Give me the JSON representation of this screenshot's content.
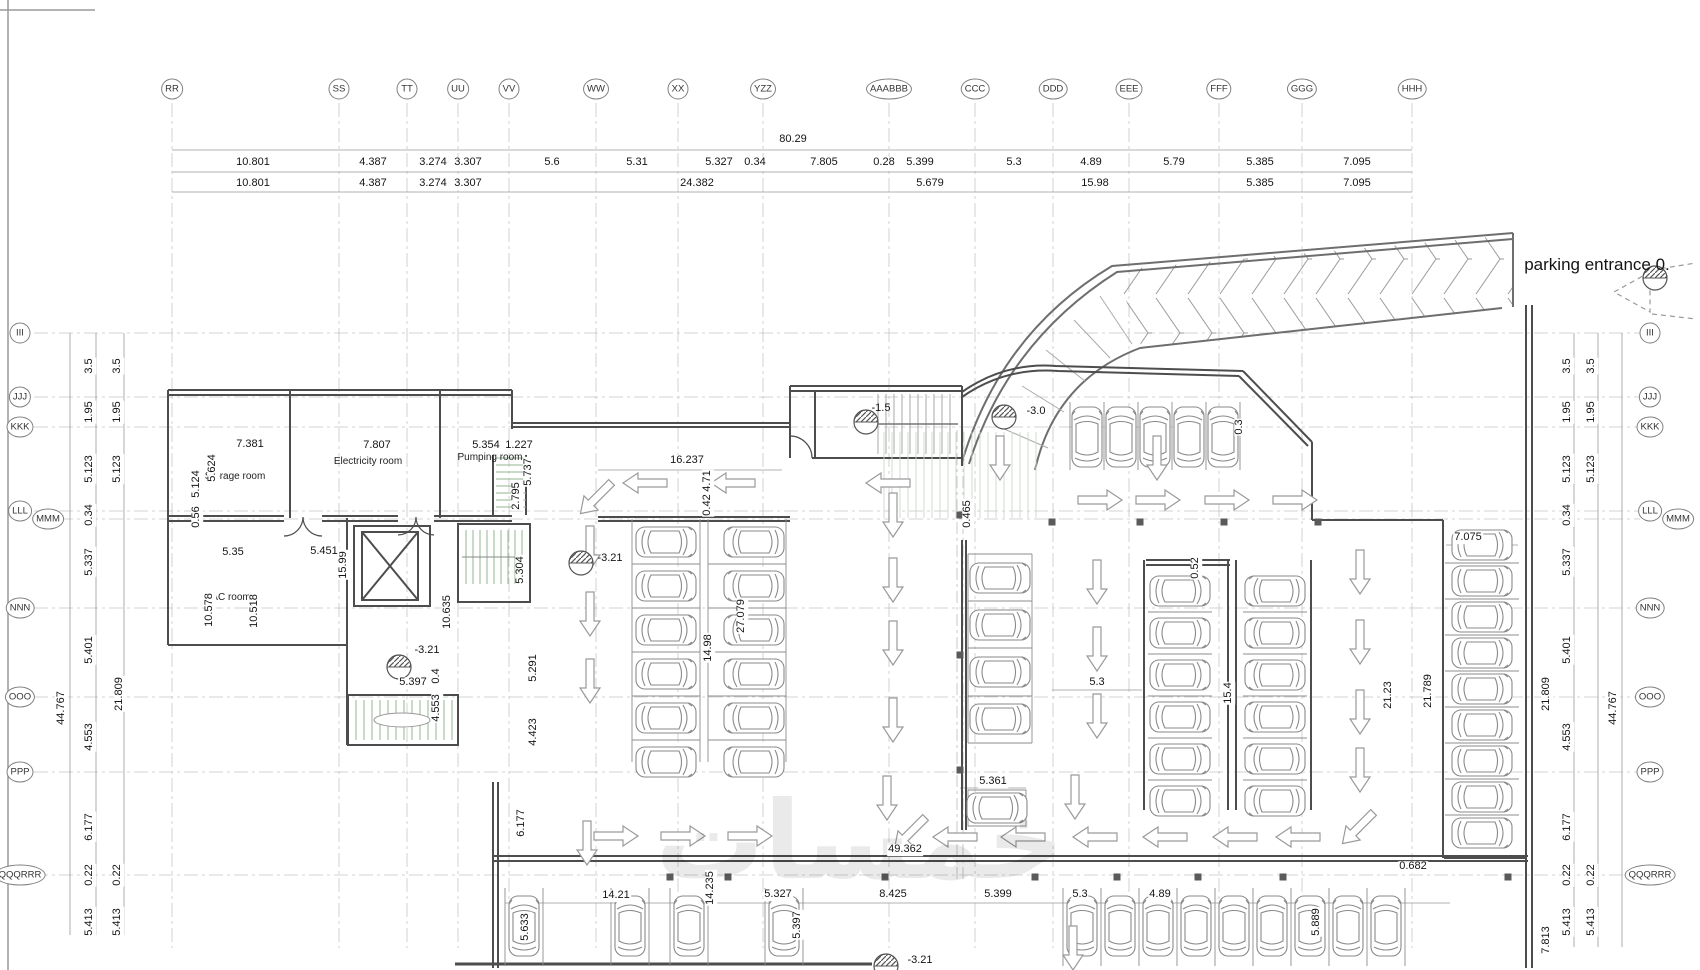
{
  "watermark": "خمسات",
  "entrance": {
    "label": "parking entrance 0."
  },
  "grid": {
    "top": [
      {
        "l": "RR",
        "x": 172
      },
      {
        "l": "SS",
        "x": 339
      },
      {
        "l": "TT",
        "x": 407
      },
      {
        "l": "UU",
        "x": 458
      },
      {
        "l": "VV",
        "x": 509
      },
      {
        "l": "WW",
        "x": 596
      },
      {
        "l": "XX",
        "x": 678
      },
      {
        "l": "YZZ",
        "x": 763
      },
      {
        "l": "AAABBB",
        "x": 889
      },
      {
        "l": "CCC",
        "x": 975
      },
      {
        "l": "DDD",
        "x": 1053
      },
      {
        "l": "EEE",
        "x": 1129
      },
      {
        "l": "FFF",
        "x": 1219
      },
      {
        "l": "GGG",
        "x": 1302
      },
      {
        "l": "HHH",
        "x": 1412
      }
    ],
    "left": [
      {
        "l": "III",
        "y": 333
      },
      {
        "l": "JJJ",
        "y": 397
      },
      {
        "l": "KKK",
        "y": 427
      },
      {
        "l": "LLL",
        "y": 511
      },
      {
        "l": "MMM",
        "y": 519,
        "x": 48
      },
      {
        "l": "NNN",
        "y": 608
      },
      {
        "l": "OOO",
        "y": 697
      },
      {
        "l": "PPP",
        "y": 772
      },
      {
        "l": "QQQRRR",
        "y": 875
      }
    ],
    "right": [
      {
        "l": "III",
        "y": 333
      },
      {
        "l": "JJJ",
        "y": 397
      },
      {
        "l": "KKK",
        "y": 427
      },
      {
        "l": "LLL",
        "y": 511
      },
      {
        "l": "MMM",
        "y": 519,
        "x": 1678
      },
      {
        "l": "NNN",
        "y": 608
      },
      {
        "l": "OOO",
        "y": 697
      },
      {
        "l": "PPP",
        "y": 772
      },
      {
        "l": "QQQRRR",
        "y": 875
      }
    ]
  },
  "labels": [
    {
      "t": "80.29",
      "x": 793,
      "y": 140
    },
    {
      "t": "10.801",
      "x": 253,
      "y": 163
    },
    {
      "t": "4.387",
      "x": 373,
      "y": 163
    },
    {
      "t": "3.274",
      "x": 433,
      "y": 163
    },
    {
      "t": "3.307",
      "x": 468,
      "y": 163
    },
    {
      "t": "5.6",
      "x": 552,
      "y": 163
    },
    {
      "t": "5.31",
      "x": 637,
      "y": 163
    },
    {
      "t": "5.327",
      "x": 719,
      "y": 163
    },
    {
      "t": "0.34",
      "x": 755,
      "y": 163
    },
    {
      "t": "7.805",
      "x": 824,
      "y": 163
    },
    {
      "t": "0.28",
      "x": 884,
      "y": 163
    },
    {
      "t": "5.399",
      "x": 920,
      "y": 163
    },
    {
      "t": "5.3",
      "x": 1014,
      "y": 163
    },
    {
      "t": "4.89",
      "x": 1091,
      "y": 163
    },
    {
      "t": "5.79",
      "x": 1174,
      "y": 163
    },
    {
      "t": "5.385",
      "x": 1260,
      "y": 163
    },
    {
      "t": "7.095",
      "x": 1357,
      "y": 163
    },
    {
      "t": "10.801",
      "x": 253,
      "y": 184
    },
    {
      "t": "4.387",
      "x": 373,
      "y": 184
    },
    {
      "t": "3.274",
      "x": 433,
      "y": 184
    },
    {
      "t": "3.307",
      "x": 468,
      "y": 184
    },
    {
      "t": "24.382",
      "x": 697,
      "y": 184
    },
    {
      "t": "5.679",
      "x": 930,
      "y": 184
    },
    {
      "t": "15.98",
      "x": 1095,
      "y": 184
    },
    {
      "t": "5.385",
      "x": 1260,
      "y": 184
    },
    {
      "t": "7.095",
      "x": 1357,
      "y": 184
    },
    {
      "t": "3.5",
      "x": 90,
      "y": 366,
      "v": 1
    },
    {
      "t": "3.5",
      "x": 118,
      "y": 366,
      "v": 1
    },
    {
      "t": "1.95",
      "x": 90,
      "y": 412,
      "v": 1
    },
    {
      "t": "1.95",
      "x": 118,
      "y": 412,
      "v": 1
    },
    {
      "t": "5.123",
      "x": 90,
      "y": 469,
      "v": 1
    },
    {
      "t": "5.123",
      "x": 118,
      "y": 469,
      "v": 1
    },
    {
      "t": "0.34",
      "x": 90,
      "y": 515,
      "v": 1
    },
    {
      "t": "5.337",
      "x": 90,
      "y": 562,
      "v": 1
    },
    {
      "t": "5.401",
      "x": 90,
      "y": 650,
      "v": 1
    },
    {
      "t": "21.809",
      "x": 120,
      "y": 694,
      "v": 1
    },
    {
      "t": "44.767",
      "x": 62,
      "y": 708,
      "v": 1
    },
    {
      "t": "4.553",
      "x": 90,
      "y": 737,
      "v": 1
    },
    {
      "t": "6.177",
      "x": 90,
      "y": 827,
      "v": 1
    },
    {
      "t": "0.22",
      "x": 90,
      "y": 875,
      "v": 1
    },
    {
      "t": "0.22",
      "x": 118,
      "y": 875,
      "v": 1
    },
    {
      "t": "5.413",
      "x": 90,
      "y": 922,
      "v": 1
    },
    {
      "t": "5.413",
      "x": 118,
      "y": 922,
      "v": 1
    },
    {
      "t": "3.5",
      "x": 1568,
      "y": 366,
      "v": 1
    },
    {
      "t": "3.5",
      "x": 1592,
      "y": 366,
      "v": 1
    },
    {
      "t": "1.95",
      "x": 1568,
      "y": 412,
      "v": 1
    },
    {
      "t": "1.95",
      "x": 1592,
      "y": 412,
      "v": 1
    },
    {
      "t": "5.123",
      "x": 1568,
      "y": 469,
      "v": 1
    },
    {
      "t": "5.123",
      "x": 1592,
      "y": 469,
      "v": 1
    },
    {
      "t": "0.34",
      "x": 1568,
      "y": 515,
      "v": 1
    },
    {
      "t": "5.337",
      "x": 1568,
      "y": 562,
      "v": 1
    },
    {
      "t": "5.401",
      "x": 1568,
      "y": 650,
      "v": 1
    },
    {
      "t": "21.809",
      "x": 1547,
      "y": 694,
      "v": 1
    },
    {
      "t": "44.767",
      "x": 1614,
      "y": 708,
      "v": 1
    },
    {
      "t": "4.553",
      "x": 1568,
      "y": 737,
      "v": 1
    },
    {
      "t": "6.177",
      "x": 1568,
      "y": 827,
      "v": 1
    },
    {
      "t": "0.22",
      "x": 1568,
      "y": 875,
      "v": 1
    },
    {
      "t": "0.22",
      "x": 1592,
      "y": 875,
      "v": 1
    },
    {
      "t": "5.413",
      "x": 1568,
      "y": 922,
      "v": 1
    },
    {
      "t": "5.413",
      "x": 1592,
      "y": 922,
      "v": 1
    },
    {
      "t": "7.813",
      "x": 1547,
      "y": 940,
      "v": 1
    },
    {
      "t": "Storage room",
      "x": 235,
      "y": 477,
      "c": "room",
      "n": "room-label-storage"
    },
    {
      "t": "Electricity room",
      "x": 368,
      "y": 462,
      "c": "room",
      "n": "room-label-electricity"
    },
    {
      "t": "Pumping room",
      "x": 490,
      "y": 458,
      "c": "room",
      "n": "room-label-pumping"
    },
    {
      "t": "AC room",
      "x": 231,
      "y": 598,
      "c": "room",
      "n": "room-label-ac"
    },
    {
      "t": "7.381",
      "x": 250,
      "y": 445
    },
    {
      "t": "7.807",
      "x": 377,
      "y": 446
    },
    {
      "t": "5.354",
      "x": 486,
      "y": 446
    },
    {
      "t": "1.227",
      "x": 519,
      "y": 446
    },
    {
      "t": "5.624",
      "x": 213,
      "y": 468,
      "v": 1
    },
    {
      "t": "5.124",
      "x": 197,
      "y": 484,
      "v": 1
    },
    {
      "t": "0.56",
      "x": 197,
      "y": 517,
      "v": 1
    },
    {
      "t": "15.99",
      "x": 344,
      "y": 565,
      "v": 1
    },
    {
      "t": "10.578",
      "x": 210,
      "y": 610,
      "v": 1
    },
    {
      "t": "10.518",
      "x": 255,
      "y": 611,
      "v": 1
    },
    {
      "t": "10.635",
      "x": 448,
      "y": 612,
      "v": 1
    },
    {
      "t": "5.304",
      "x": 521,
      "y": 570,
      "v": 1
    },
    {
      "t": "2.795",
      "x": 517,
      "y": 496,
      "v": 1
    },
    {
      "t": "5.737",
      "x": 529,
      "y": 472,
      "v": 1
    },
    {
      "t": "5.291",
      "x": 534,
      "y": 668,
      "v": 1
    },
    {
      "t": "4.423",
      "x": 534,
      "y": 732,
      "v": 1
    },
    {
      "t": "0.4",
      "x": 437,
      "y": 676,
      "v": 1
    },
    {
      "t": "4.553",
      "x": 437,
      "y": 708,
      "v": 1
    },
    {
      "t": "5.35",
      "x": 233,
      "y": 553
    },
    {
      "t": "5.451",
      "x": 324,
      "y": 552
    },
    {
      "t": "16.237",
      "x": 687,
      "y": 461
    },
    {
      "t": "4.71",
      "x": 708,
      "y": 481,
      "v": 1
    },
    {
      "t": "0.42",
      "x": 708,
      "y": 505,
      "v": 1
    },
    {
      "t": "14.98",
      "x": 709,
      "y": 648,
      "v": 1
    },
    {
      "t": "27.079",
      "x": 742,
      "y": 616,
      "v": 1
    },
    {
      "t": "-3.21",
      "x": 610,
      "y": 559,
      "c": "spot",
      "n": "spot-elevation-label"
    },
    {
      "t": "-3.21",
      "x": 427,
      "y": 651,
      "c": "spot",
      "n": "spot-elevation-label"
    },
    {
      "t": "5.397",
      "x": 413,
      "y": 683
    },
    {
      "t": "-1.5",
      "x": 881,
      "y": 409,
      "c": "spot",
      "n": "spot-elevation-label"
    },
    {
      "t": "-3.0",
      "x": 1036,
      "y": 412,
      "c": "spot",
      "n": "spot-elevation-label"
    },
    {
      "t": "0.3",
      "x": 1240,
      "y": 427,
      "v": 1
    },
    {
      "t": "0.465",
      "x": 968,
      "y": 514,
      "v": 1
    },
    {
      "t": "0.52",
      "x": 1196,
      "y": 568,
      "v": 1
    },
    {
      "t": "5.3",
      "x": 1097,
      "y": 683
    },
    {
      "t": "15.4",
      "x": 1229,
      "y": 693,
      "v": 1
    },
    {
      "t": "21.23",
      "x": 1389,
      "y": 695,
      "v": 1
    },
    {
      "t": "21.789",
      "x": 1429,
      "y": 691,
      "v": 1
    },
    {
      "t": "7.075",
      "x": 1468,
      "y": 538
    },
    {
      "t": "5.361",
      "x": 993,
      "y": 782
    },
    {
      "t": "49.362",
      "x": 905,
      "y": 850
    },
    {
      "t": "0.682",
      "x": 1413,
      "y": 867
    },
    {
      "t": "5.889",
      "x": 1317,
      "y": 922,
      "v": 1
    },
    {
      "t": "6.177",
      "x": 522,
      "y": 823,
      "v": 1
    },
    {
      "t": "5.633",
      "x": 526,
      "y": 927,
      "v": 1
    },
    {
      "t": "14.21",
      "x": 616,
      "y": 896
    },
    {
      "t": "14.235",
      "x": 711,
      "y": 888,
      "v": 1
    },
    {
      "t": "5.327",
      "x": 778,
      "y": 895
    },
    {
      "t": "5.397",
      "x": 798,
      "y": 925,
      "v": 1
    },
    {
      "t": "8.425",
      "x": 893,
      "y": 895
    },
    {
      "t": "5.399",
      "x": 998,
      "y": 895
    },
    {
      "t": "5.3",
      "x": 1080,
      "y": 895
    },
    {
      "t": "4.89",
      "x": 1160,
      "y": 895
    },
    {
      "t": "-3.21",
      "x": 920,
      "y": 961,
      "c": "spot",
      "n": "spot-elevation-label"
    },
    {
      "t": "parking entrance 0.",
      "x": 1597,
      "y": 265,
      "c": "big",
      "n": "entrance-label"
    }
  ]
}
